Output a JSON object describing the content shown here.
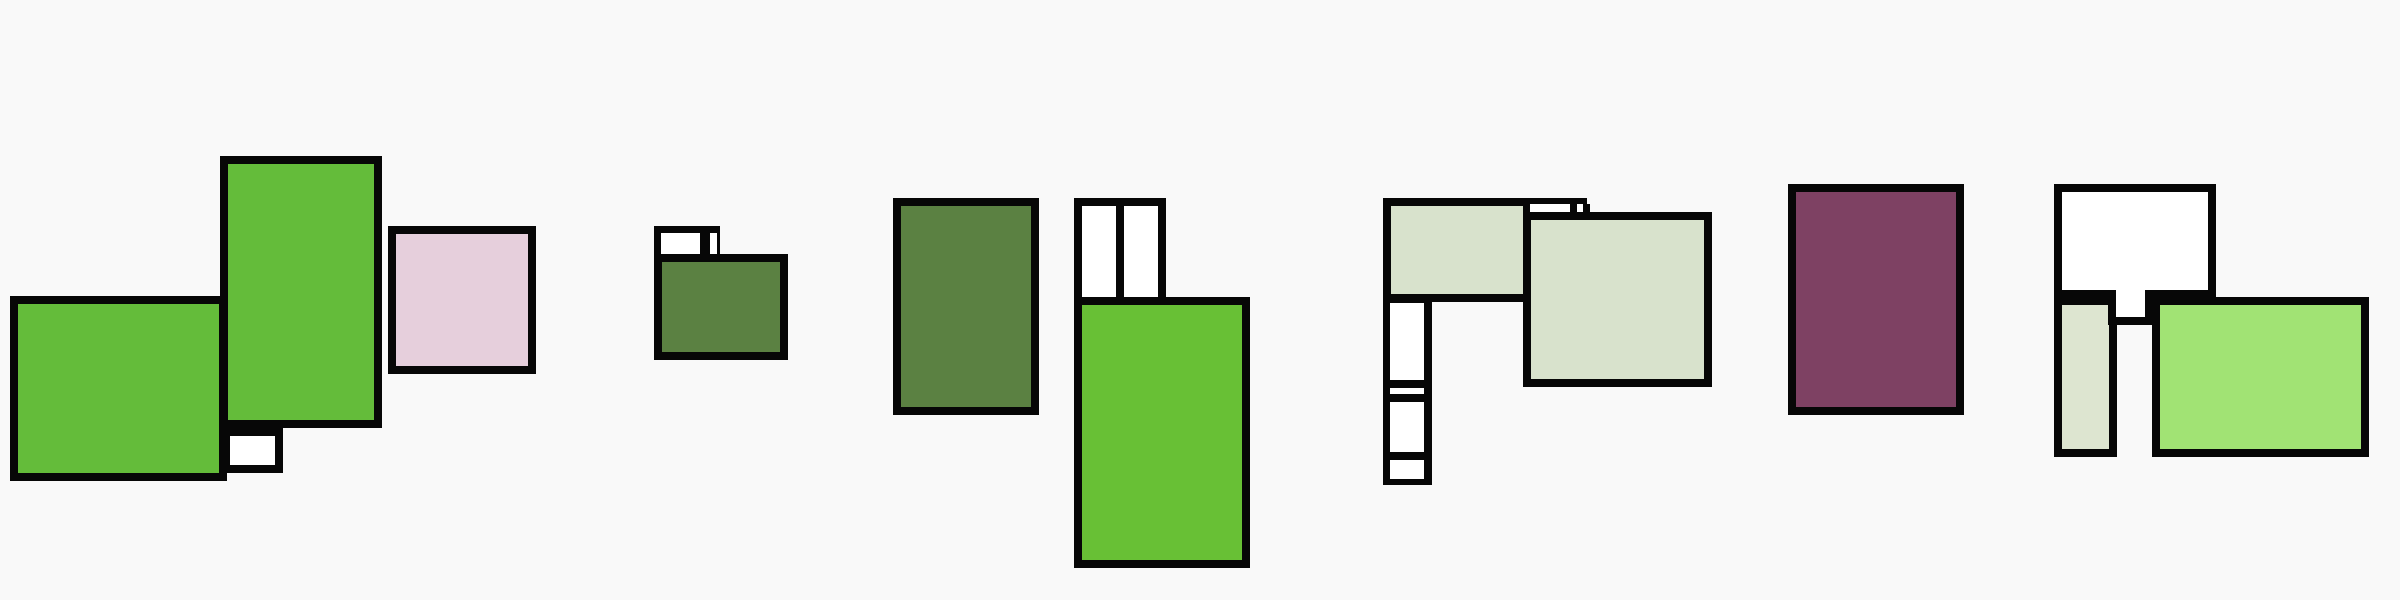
{
  "canvas": {
    "width": 2400,
    "height": 600,
    "background": "#f9f9f9",
    "border_color": "#070707",
    "border_width": 8
  },
  "palette": {
    "bright_green": "#64bc3a",
    "bright_green_light": "#68c035",
    "olive_green": "#5b8142",
    "pale_green": "#d8e2cc",
    "pale_green_column": "#dde5d0",
    "light_green": "#a1e374",
    "pink": "#e6cfdc",
    "purple": "#7e4163",
    "white": "#ffffff",
    "black": "#070707"
  },
  "shapes": [
    {
      "name": "cluster1-green-left-block",
      "x": 10,
      "y": 296,
      "w": 217,
      "h": 185,
      "fill": "#64bc3a"
    },
    {
      "name": "cluster1-white-small-block",
      "x": 222,
      "y": 428,
      "w": 61,
      "h": 45,
      "fill": "#ffffff"
    },
    {
      "name": "cluster1-green-tall-block",
      "x": 220,
      "y": 156,
      "w": 162,
      "h": 272,
      "fill": "#64bc3a"
    },
    {
      "name": "cluster1-pink-block",
      "x": 388,
      "y": 226,
      "w": 148,
      "h": 148,
      "fill": "#e6cfdc"
    },
    {
      "name": "cluster2-tab-frame",
      "x": 654,
      "y": 226,
      "w": 66,
      "h": 34,
      "fill": "#070707",
      "border": 0
    },
    {
      "name": "cluster2-tab-cell-left",
      "x": 661,
      "y": 233,
      "w": 39,
      "h": 27,
      "fill": "#ffffff",
      "border": 0
    },
    {
      "name": "cluster2-tab-cell-right",
      "x": 710,
      "y": 233,
      "w": 7,
      "h": 27,
      "fill": "#ffffff",
      "border": 0
    },
    {
      "name": "cluster2-olive-block",
      "x": 654,
      "y": 254,
      "w": 134,
      "h": 106,
      "fill": "#5b8142"
    },
    {
      "name": "cluster3-olive-block",
      "x": 893,
      "y": 198,
      "w": 146,
      "h": 217,
      "fill": "#5b8142"
    },
    {
      "name": "cluster3-pair-frame",
      "x": 1074,
      "y": 198,
      "w": 92,
      "h": 106,
      "fill": "#070707",
      "border": 0
    },
    {
      "name": "cluster3-pair-cell-left",
      "x": 1082,
      "y": 206,
      "w": 34,
      "h": 98,
      "fill": "#ffffff",
      "border": 0
    },
    {
      "name": "cluster3-pair-cell-right",
      "x": 1124,
      "y": 206,
      "w": 34,
      "h": 98,
      "fill": "#ffffff",
      "border": 0
    },
    {
      "name": "cluster3-green-big-block",
      "x": 1074,
      "y": 297,
      "w": 176,
      "h": 271,
      "fill": "#68c035"
    },
    {
      "name": "cluster4-column-frame",
      "x": 1383,
      "y": 198,
      "w": 49,
      "h": 287,
      "fill": "#070707",
      "border": 0
    },
    {
      "name": "cluster4-column-cell-1",
      "x": 1390,
      "y": 303,
      "w": 34,
      "h": 77,
      "fill": "#ffffff",
      "border": 0
    },
    {
      "name": "cluster4-column-strip",
      "x": 1390,
      "y": 388,
      "w": 34,
      "h": 6,
      "fill": "#ffffff",
      "border": 0
    },
    {
      "name": "cluster4-column-cell-2",
      "x": 1390,
      "y": 402,
      "w": 34,
      "h": 50,
      "fill": "#ffffff",
      "border": 0
    },
    {
      "name": "cluster4-column-cell-3",
      "x": 1390,
      "y": 460,
      "w": 34,
      "h": 19,
      "fill": "#ffffff",
      "border": 0
    },
    {
      "name": "cluster4-horizontal-block",
      "x": 1383,
      "y": 198,
      "w": 204,
      "h": 104,
      "fill": "#d8e2cc"
    },
    {
      "name": "cluster4-sliver-frame",
      "x": 1523,
      "y": 204,
      "w": 67,
      "h": 15,
      "fill": "#070707",
      "border": 0
    },
    {
      "name": "cluster4-sliver-cell-1",
      "x": 1530,
      "y": 204,
      "w": 40,
      "h": 8,
      "fill": "#ffffff",
      "border": 0
    },
    {
      "name": "cluster4-sliver-cell-2",
      "x": 1577,
      "y": 204,
      "w": 6,
      "h": 8,
      "fill": "#ffffff",
      "border": 0
    },
    {
      "name": "cluster4-square-block",
      "x": 1523,
      "y": 212,
      "w": 189,
      "h": 175,
      "fill": "#d8e2cc"
    },
    {
      "name": "cluster5-purple-block",
      "x": 1788,
      "y": 184,
      "w": 176,
      "h": 231,
      "fill": "#7e4163"
    },
    {
      "name": "cluster6-pale-column-block",
      "x": 2054,
      "y": 297,
      "w": 63,
      "h": 160,
      "fill": "#dde5d0"
    },
    {
      "name": "cluster6-light-green-block",
      "x": 2152,
      "y": 297,
      "w": 217,
      "h": 160,
      "fill": "#a1e374"
    },
    {
      "name": "cluster6-white-block",
      "x": 2054,
      "y": 184,
      "w": 162,
      "h": 114,
      "fill": "#ffffff"
    },
    {
      "name": "cluster6-white-tab",
      "x": 2108,
      "y": 290,
      "w": 45,
      "h": 35,
      "fill": "#ffffff",
      "bt": 0
    }
  ]
}
